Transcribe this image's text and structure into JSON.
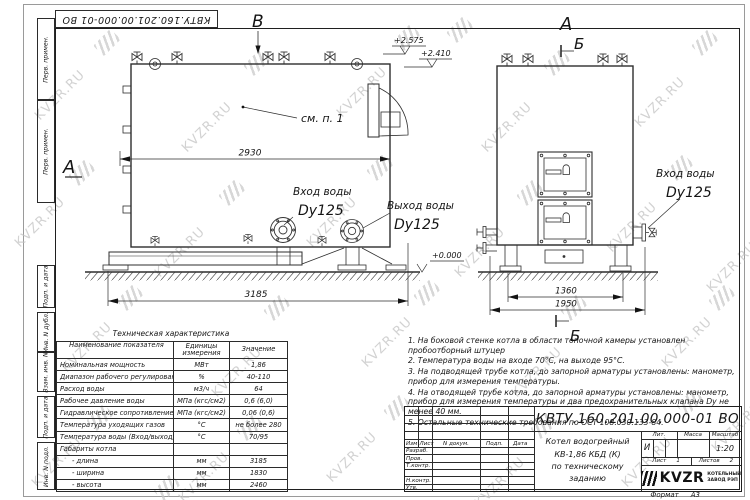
{
  "sheet": {
    "watermark": "KVZR.RU",
    "doc_number": "КВТУ.160.201.00.000-01 ВО",
    "format_label": "Формат",
    "format_value": "А3"
  },
  "stamp_column": {
    "cell_top_1": "Перв. примен.",
    "cell_top_2": "Перв. примен.",
    "cell_1": "Подп. и дата",
    "cell_2": "Инв. N дубл.",
    "cell_3": "Взам. инв. N",
    "cell_4": "Подп. и дата",
    "cell_5": "Инв. N подл."
  },
  "drawing": {
    "view_label_a_left": "А",
    "view_label_b_top": "В",
    "view_label_a_right": "А",
    "section_label_b_top": "Б",
    "section_label_b_bottom": "Б",
    "see_note_label": "см. п. 1",
    "water_inlet_left": "Вход воды",
    "water_inlet_left_dn": "Dy125",
    "water_outlet": "Выход воды",
    "water_outlet_dn": "Dy125",
    "water_inlet_right": "Вход воды",
    "water_inlet_right_dn": "Dy125",
    "dim_inner_length": "2930",
    "dim_overall_length": "3185",
    "dim_front_width": "1360",
    "dim_front_overall": "1950",
    "elev_top_high": "+2.575",
    "elev_top_low": "+2.410",
    "elev_ground": "+0.000"
  },
  "spec_table": {
    "title": "Техническая характеристика",
    "col_name": "Наименование показателя",
    "col_units_1": "Единицы",
    "col_units_2": "измерения",
    "col_value": "Значение",
    "rows": [
      [
        "Номинальная мощность",
        "МВт",
        "1,86"
      ],
      [
        "Диапазон рабочего регулирования",
        "%",
        "40-110"
      ],
      [
        "Расход воды",
        "м3/ч",
        "64"
      ],
      [
        "Рабочее давление воды",
        "МПа (кгс/см2)",
        "0,6 (6,0)"
      ],
      [
        "Гидравлическое сопротивление котла",
        "МПа (кгс/см2)",
        "0,06 (0,6)"
      ],
      [
        "Температура уходящих газов",
        "°С",
        "не более 280"
      ],
      [
        "Температура воды (Вход/выход)",
        "°С",
        "70/95"
      ],
      [
        "Габариты котла",
        "",
        ""
      ],
      [
        "- длина",
        "мм",
        "3185"
      ],
      [
        "- ширина",
        "мм",
        "1830"
      ],
      [
        "- высота",
        "мм",
        "2460"
      ]
    ]
  },
  "notes": {
    "n1": "1.  На боковой стенке котла в области топочной камеры установлен пробоотборный штуцер",
    "n2": "2.  Температура воды на входе 70°С, на выходе 95°С.",
    "n3": "3.  На подводящей трубе котла, до запорной арматуры установлены: манометр, прибор для измерения температуры.",
    "n4": "4.  На отводящей трубе котла, до запорной арматуры установлены: манометр, прибор для измерения температуры и два предохранительных клапана  Dу не менее 40 мм.",
    "n5": "5.  Остальные технические требования по ОСТ  108.030.133-84."
  },
  "title_block": {
    "doc_number": "КВТУ.160.201.00.000-01 ВО",
    "name_line1": "Котел водогрейный",
    "name_line2": "КВ-1,86 КБД (К)",
    "name_line3": "по техническому заданию",
    "col_izm": "Изм",
    "col_list": "Лист",
    "col_ndoc": "N докум.",
    "col_podp": "Подп.",
    "col_data": "Дата",
    "row_razrab": "Разраб.",
    "row_prov": "Пров.",
    "row_tkontr": "Т.контр.",
    "row_nkontr": "Н.контр.",
    "row_utv": "Утв.",
    "lit_label": "Лит.",
    "lit_value": "И",
    "mass_label": "Масса",
    "scale_label": "Масштаб",
    "scale_value": "1:20",
    "sheet_label": "Лист",
    "sheet_value": "1",
    "sheets_label": "Листов",
    "sheets_value": "2",
    "logo_text": "KVZR",
    "company_line1": "КОТЕЛЬНЫЙ",
    "company_line2": "ЗАВОД РЭП"
  }
}
